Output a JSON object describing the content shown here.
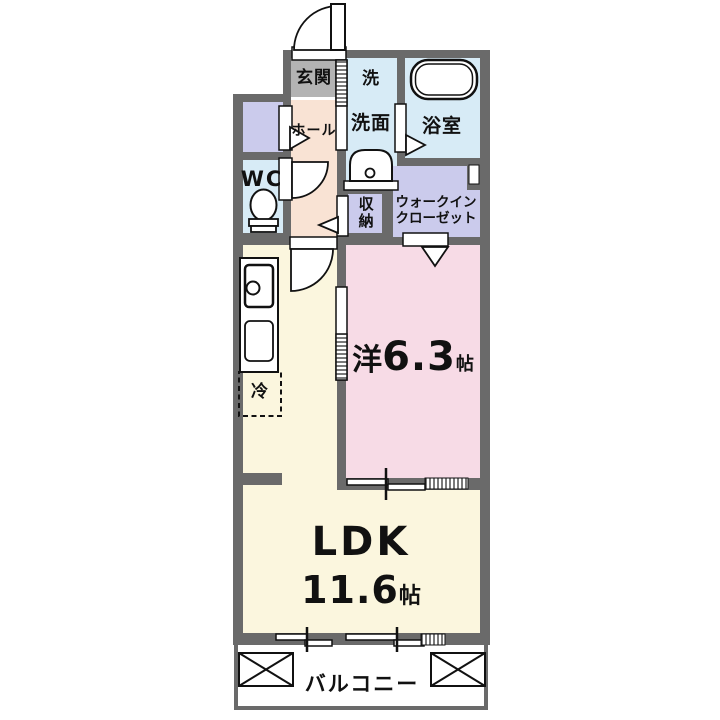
{
  "rooms": {
    "genkan": {
      "label": "玄関"
    },
    "hall": {
      "label": "ホール"
    },
    "wc": {
      "label": "WC"
    },
    "washer": {
      "label": "洗"
    },
    "washroom": {
      "label": "洗面"
    },
    "bathroom": {
      "label": "浴室"
    },
    "storage": {
      "label": "収納"
    },
    "wic": {
      "line1": "ウォークイン",
      "line2": "クローゼット"
    },
    "western": {
      "prefix": "洋",
      "size": "6.3",
      "unit": "帖"
    },
    "ldk": {
      "label": "LDK",
      "size": "11.6",
      "unit": "帖"
    },
    "fridge": {
      "label": "冷"
    },
    "balcony": {
      "label": "バルコニー"
    }
  },
  "colors": {
    "wall": "#6a6a6a",
    "genkan_floor": "#b3b3b3",
    "hall_floor": "#f9e3d4",
    "wet_floor": "#d7ebf6",
    "closet_floor": "#cbcbec",
    "western_floor": "#f7dbe6",
    "ldk_floor": "#fbf6de",
    "balcony_floor": "#ffffff"
  }
}
